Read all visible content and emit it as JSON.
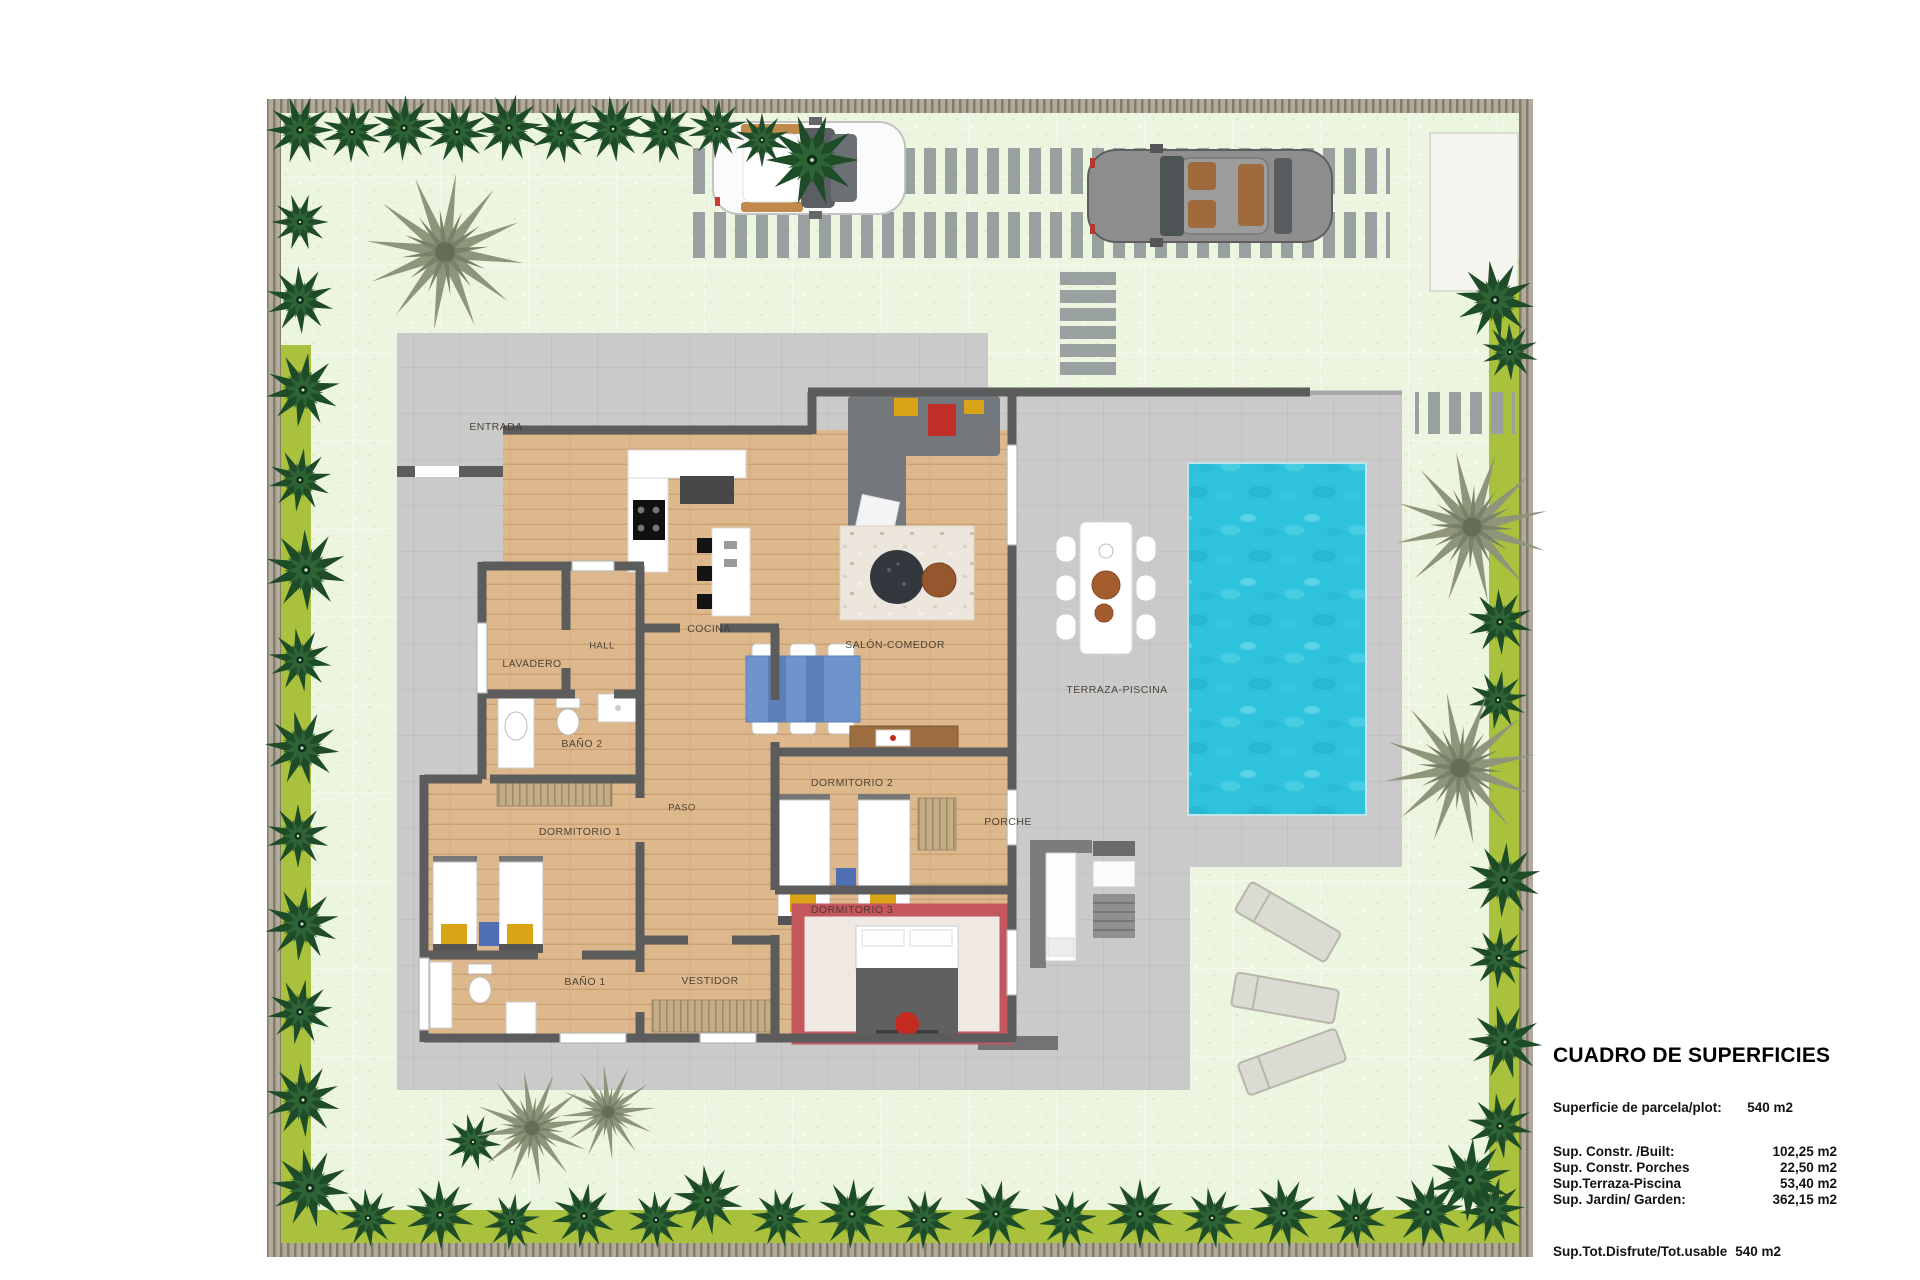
{
  "plan": {
    "rooms": [
      {
        "id": "entrada",
        "label": "ENTRADA"
      },
      {
        "id": "lavadero",
        "label": "LAVADERO"
      },
      {
        "id": "hall",
        "label": "HALL"
      },
      {
        "id": "cocina",
        "label": "COCINA"
      },
      {
        "id": "salon_comedor",
        "label": "SALÓN-COMEDOR"
      },
      {
        "id": "bano2",
        "label": "BAÑO 2"
      },
      {
        "id": "paso",
        "label": "PASO"
      },
      {
        "id": "dormitorio1",
        "label": "DORMITORIO 1"
      },
      {
        "id": "dormitorio2",
        "label": "DORMITORIO 2"
      },
      {
        "id": "dormitorio3",
        "label": "DORMITORIO 3"
      },
      {
        "id": "bano1",
        "label": "BAÑO 1"
      },
      {
        "id": "vestidor",
        "label": "VESTIDOR"
      },
      {
        "id": "porche",
        "label": "PORCHE"
      },
      {
        "id": "terraza_piscina",
        "label": "TERRAZA-PISCINA"
      }
    ],
    "colors": {
      "lawn": "#ecf5df",
      "hedge": "#a9c13d",
      "tree": "#1e4b28",
      "palm": "#8e957b",
      "terrace": "#cacaca",
      "wall": "#5c5c5c",
      "wood_floor": "#ddb88d",
      "pool": "#2fc2dc",
      "accent_yellow": "#d9a418",
      "accent_red": "#c03028",
      "accent_blue": "#4f6fb5"
    }
  },
  "surface_table": {
    "title": "CUADRO DE SUPERFICIES",
    "parcel": {
      "label": "Superficie de parcela/plot:",
      "value": "540 m2"
    },
    "rows": [
      {
        "label": "Sup. Constr. /Built:",
        "value": "102,25 m2"
      },
      {
        "label": "Sup. Constr. Porches",
        "value": "22,50 m2"
      },
      {
        "label": "Sup.Terraza-Piscina",
        "value": "53,40 m2"
      },
      {
        "label": "Sup. Jardin/ Garden:",
        "value": "362,15 m2"
      }
    ],
    "total": {
      "label": "Sup.Tot.Disfrute/Tot.usable",
      "value": "540 m2"
    }
  }
}
